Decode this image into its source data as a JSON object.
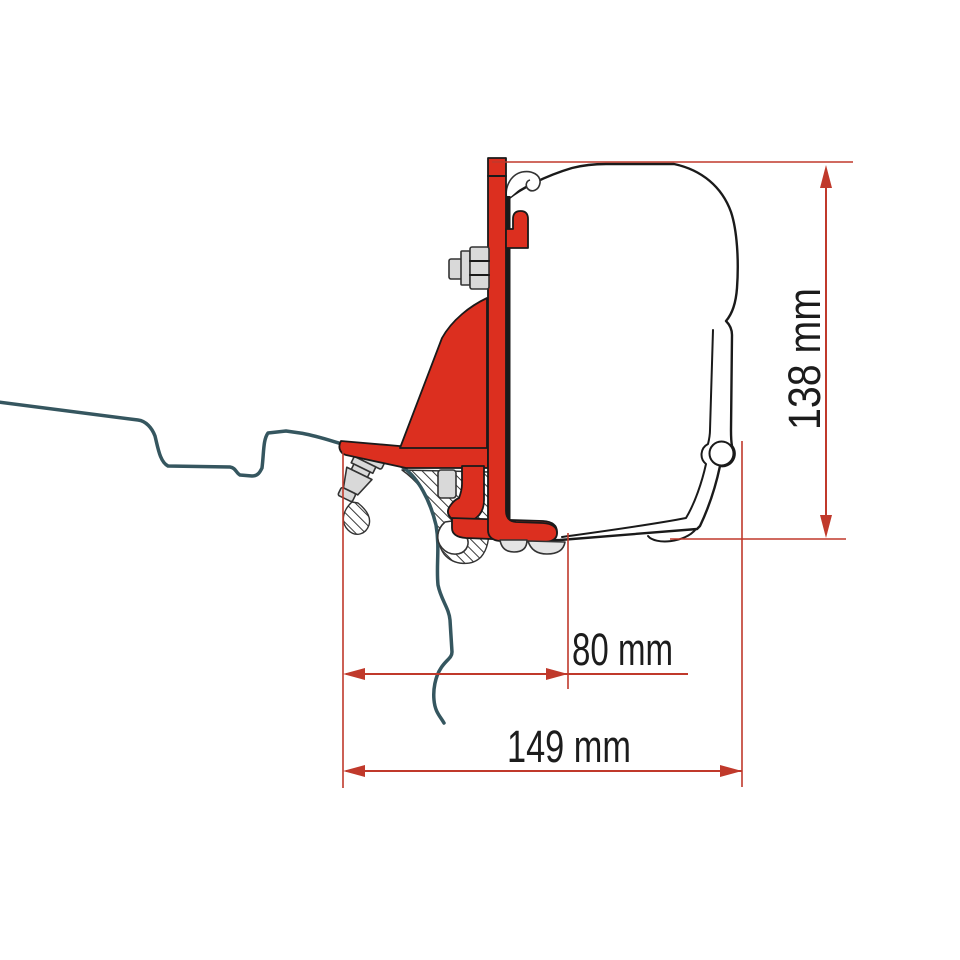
{
  "diagram": {
    "kind": "awning-adapter-bracket-side-profile",
    "labels": {
      "height": "138 mm",
      "bracket_depth": "80 mm",
      "total_depth": "149 mm"
    }
  },
  "colors": {
    "bracket-red": "#dc2f1f",
    "dim-red": "#c0392b",
    "roof-teal": "#35565f",
    "outline": "#1a1a1a",
    "outline-soft": "#333333",
    "metal-gray": "#d9d9d9",
    "pad-gray": "#e4e4e4",
    "case-white": "#ffffff",
    "text-color": "#1c1c1c"
  }
}
